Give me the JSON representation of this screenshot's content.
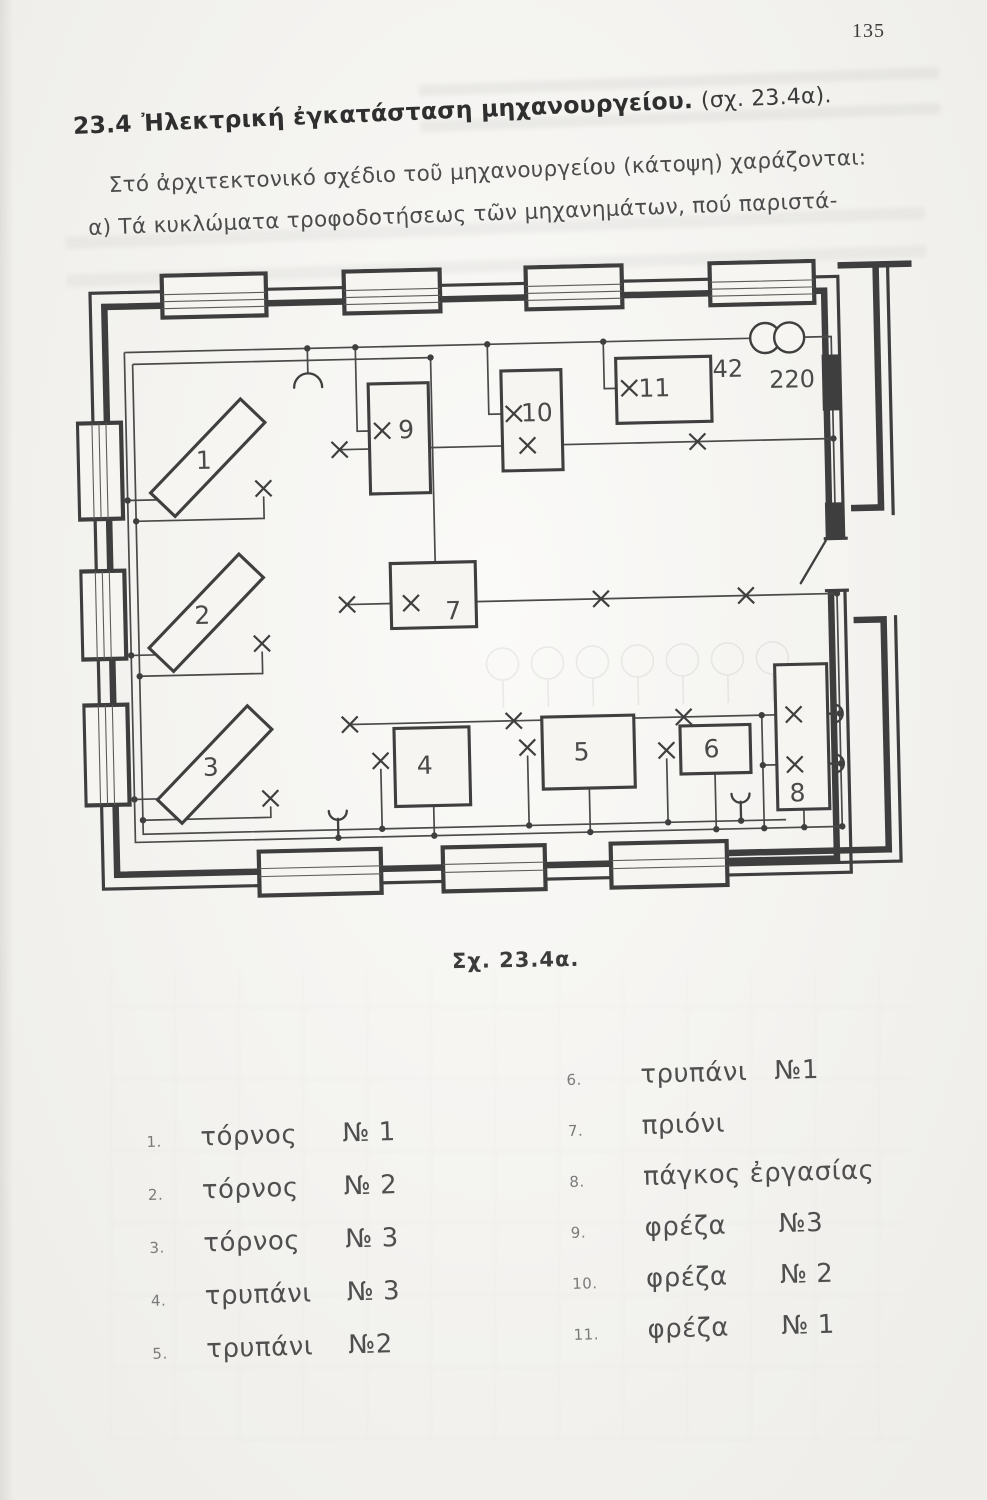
{
  "page": {
    "number": "135"
  },
  "heading": {
    "section_number": "23.4",
    "title": "Ἠλεκτρική ἐγκατάσταση μηχανουργείου.",
    "figure_ref": "(σχ. 23.4α)."
  },
  "paragraph": {
    "line1": "Στό ἀρχιτεκτονικό σχέδιο τοῦ μηχανουργείου (κάτοψη) χαράζονται:",
    "line2": "α) Τά κυκλώματα τροφοδοτήσεως τῶν μηχανημάτων, πού παριστά-"
  },
  "figure": {
    "caption": "Σχ. 23.4α.",
    "plan": {
      "machine_labels": [
        "1",
        "2",
        "3",
        "4",
        "5",
        "6",
        "7",
        "8",
        "9",
        "10",
        "11"
      ],
      "transformer": {
        "primary_label": "42",
        "secondary_label": "220"
      }
    }
  },
  "legend": {
    "left": [
      {
        "num": "1.",
        "name": "τόρνος",
        "no": "№ 1"
      },
      {
        "num": "2.",
        "name": "τόρνος",
        "no": "№ 2"
      },
      {
        "num": "3.",
        "name": "τόρνος",
        "no": "№ 3"
      },
      {
        "num": "4.",
        "name": "τρυπάνι",
        "no": "№ 3"
      },
      {
        "num": "5.",
        "name": "τρυπάνι",
        "no": "№2"
      }
    ],
    "right": [
      {
        "num": "6.",
        "name": "τρυπάνι",
        "no": "№1"
      },
      {
        "num": "7.",
        "name": "πριόνι",
        "no": ""
      },
      {
        "num": "8.",
        "name": "πάγκος ἐργασίας",
        "no": ""
      },
      {
        "num": "9.",
        "name": "φρέζα",
        "no": "№3"
      },
      {
        "num": "10.",
        "name": "φρέζα",
        "no": "№ 2"
      },
      {
        "num": "11.",
        "name": "φρέζα",
        "no": "№ 1"
      }
    ]
  }
}
